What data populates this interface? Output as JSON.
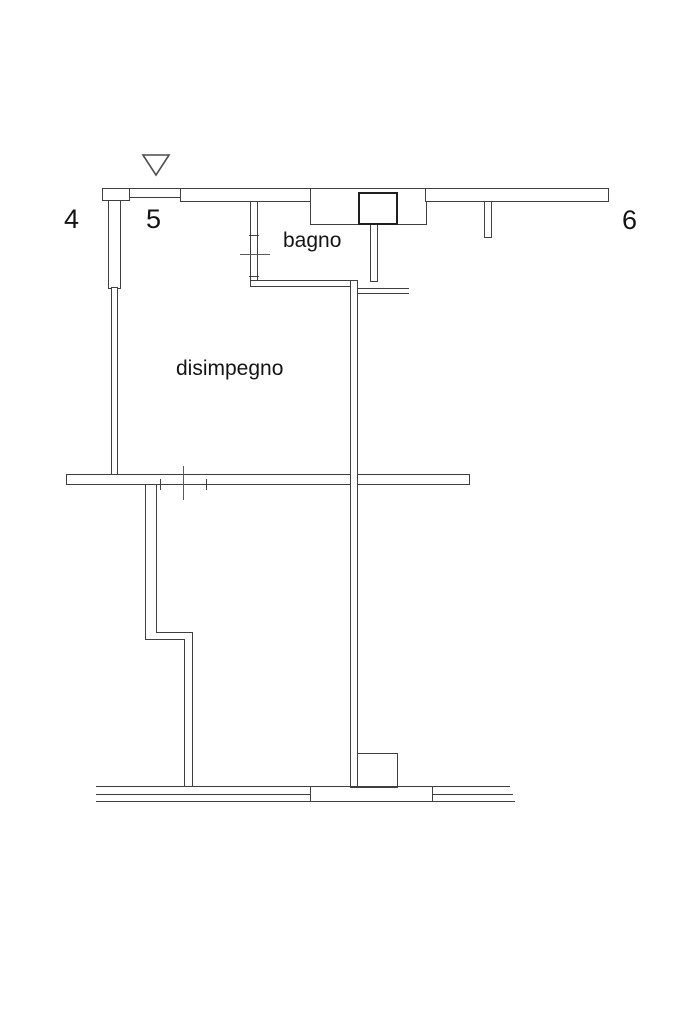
{
  "floor_plan": {
    "labels": {
      "room_bagno": "bagno",
      "room_disimpegno": "disimpegno",
      "marker_4": "4",
      "marker_5": "5",
      "marker_6": "6"
    },
    "icons": {
      "triangle_marker": "open-triangle-pointing-down"
    },
    "colors": {
      "background": "#ffffff",
      "wall_line": "#3f3f3f",
      "dark_line": "#1f1f1f",
      "light_line": "#5a5a5a",
      "text": "#141414"
    }
  }
}
